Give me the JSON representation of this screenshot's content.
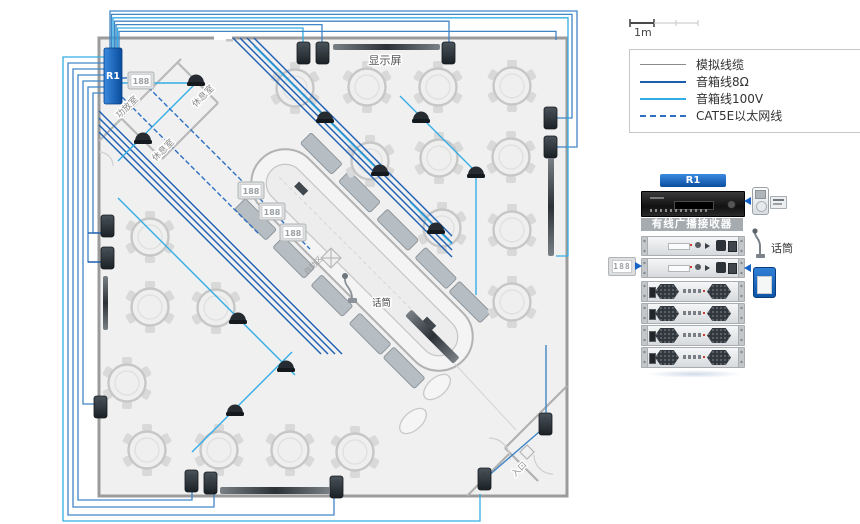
{
  "scale_bar": {
    "label": "1m"
  },
  "legend": {
    "items": [
      {
        "label": "模拟线缆",
        "color": "#8a8a8a",
        "style": "solid"
      },
      {
        "label": "音箱线8Ω",
        "color": "#1c5fae",
        "style": "solid"
      },
      {
        "label": "音箱线100V",
        "color": "#33aee4",
        "style": "solid"
      },
      {
        "label": "CAT5E以太网线",
        "color": "#2e6fc2",
        "style": "dashed"
      }
    ]
  },
  "floorplan": {
    "r1_label": "R1",
    "clock_digits": "188",
    "display_screen_label": "显示屏",
    "amp_room_label": "功放室",
    "lounge_label": "休息室",
    "buffet_zone_label": "自助区",
    "mic_label": "话筒",
    "entrance_label": "入口"
  },
  "rack": {
    "banner_label": "R1",
    "receiver_label": "有线广播接收器",
    "mic_label": "话筒",
    "clock_digits": "188"
  },
  "colors": {
    "accent_blue": "#1663c7",
    "cable_analog": "#8a8a8a",
    "cable_8ohm": "#1c5fae",
    "cable_100v": "#33aee4",
    "cable_cat5e": "#2e6fc2"
  }
}
